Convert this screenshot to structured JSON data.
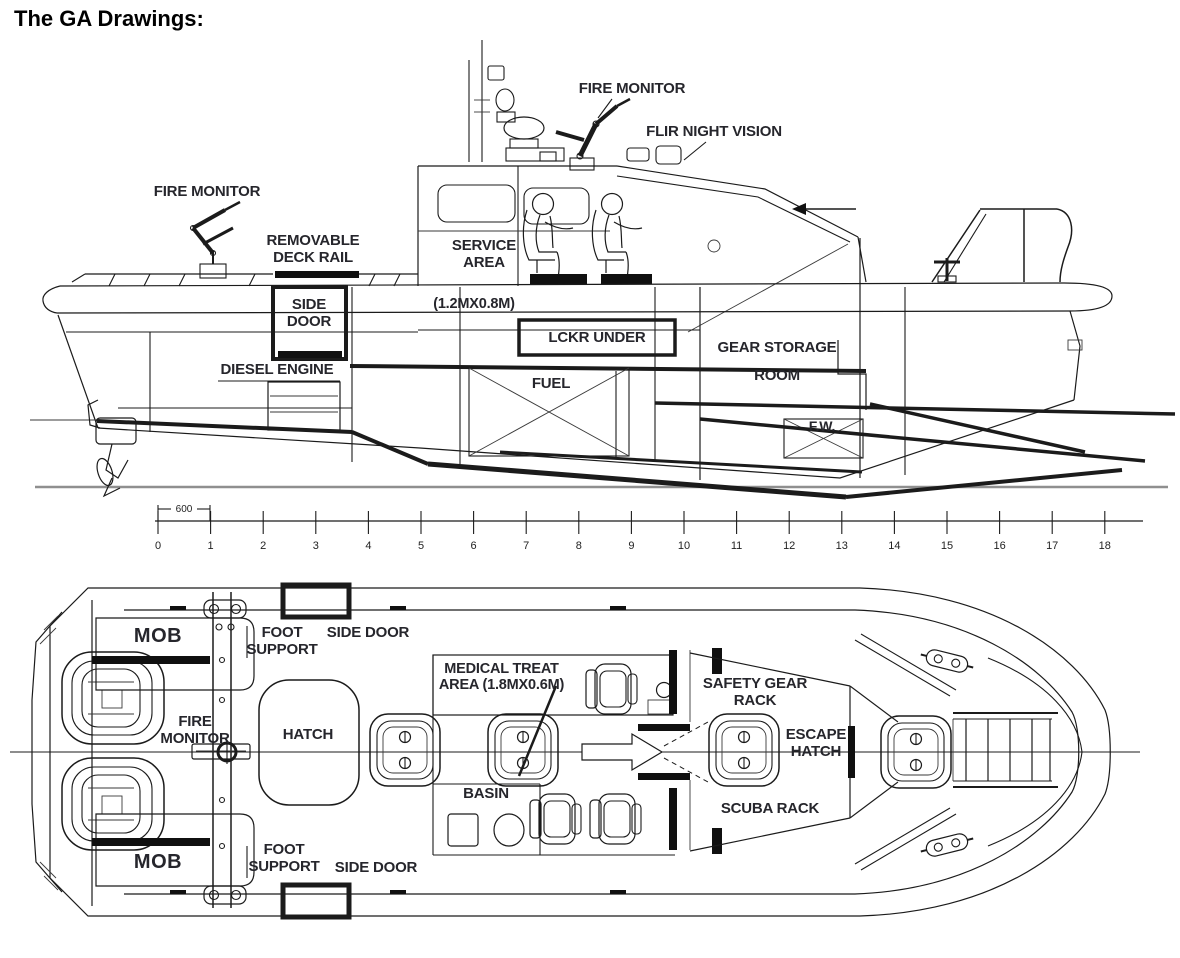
{
  "title": "The GA Drawings:",
  "colors": {
    "ink": "#1b1b1b",
    "label_text": "#26262c",
    "baseline_gray": "#8f8f8f"
  },
  "side_view": {
    "fire_monitor_top": "FIRE MONITOR",
    "flir_night_vision": "FLIR NIGHT VISION",
    "fire_monitor_aft": "FIRE MONITOR",
    "removable_deck_rail": "REMOVABLE DECK RAIL",
    "service_area": "SERVICE AREA",
    "service_area_dim": "(1.2MX0.8M)",
    "side_door": "SIDE DOOR",
    "lckr_under": "LCKR UNDER",
    "gear_storage_room": "GEAR STORAGE ROOM",
    "diesel_engine": "DIESEL ENGINE",
    "fuel": "FUEL",
    "fresh_water": "F.W."
  },
  "ruler": {
    "dim_label": "600",
    "ticks": [
      "0",
      "1",
      "2",
      "3",
      "4",
      "5",
      "6",
      "7",
      "8",
      "9",
      "10",
      "11",
      "12",
      "13",
      "14",
      "15",
      "16",
      "17",
      "18"
    ]
  },
  "plan_view": {
    "mob_top": "MOB",
    "mob_bottom": "MOB",
    "foot_support_top": "FOOT SUPPORT",
    "foot_support_bottom": "FOOT SUPPORT",
    "side_door_top": "SIDE DOOR",
    "side_door_bottom": "SIDE DOOR",
    "medical_treat_area": "MEDICAL TREAT AREA (1.8MX0.6M)",
    "safety_gear_rack": "SAFETY GEAR RACK",
    "fire_monitor": "FIRE MONITOR",
    "hatch": "HATCH",
    "escape_hatch": "ESCAPE HATCH",
    "basin": "BASIN",
    "scuba_rack": "SCUBA RACK"
  }
}
